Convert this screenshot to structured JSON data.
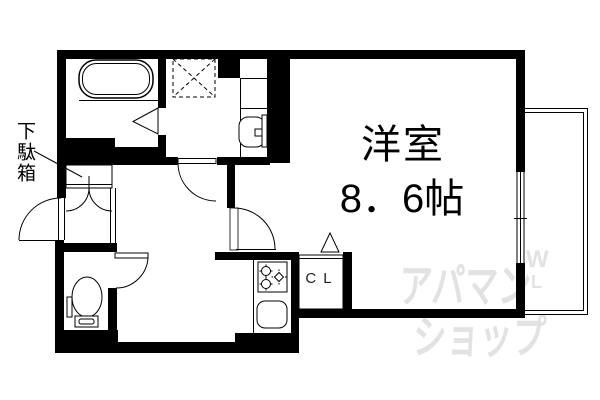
{
  "page": {
    "background": "#ffffff"
  },
  "plan": {
    "wall_color": "#000000",
    "line_color": "#000000",
    "rooms": {
      "main_room": {
        "label": "洋室",
        "size": "8．6帖"
      },
      "closet": {
        "label": "CL"
      },
      "shoe_cabinet": {
        "label": "下駄箱"
      }
    },
    "fixtures": [
      "bathtub",
      "washing-machine-pan",
      "wash-basin",
      "toilet",
      "gas-stove",
      "kitchen-sink",
      "shoe-cabinet",
      "balcony",
      "window",
      "entrance-door",
      "bathroom-folding-door",
      "toilet-door",
      "washroom-door",
      "main-room-door",
      "closet-door-triangle"
    ],
    "watermark": {
      "text_line1": "アパマン",
      "text_line2": "ショップ",
      "letter1": "W",
      "letter2": "L",
      "color": "#e2e2e2"
    }
  }
}
